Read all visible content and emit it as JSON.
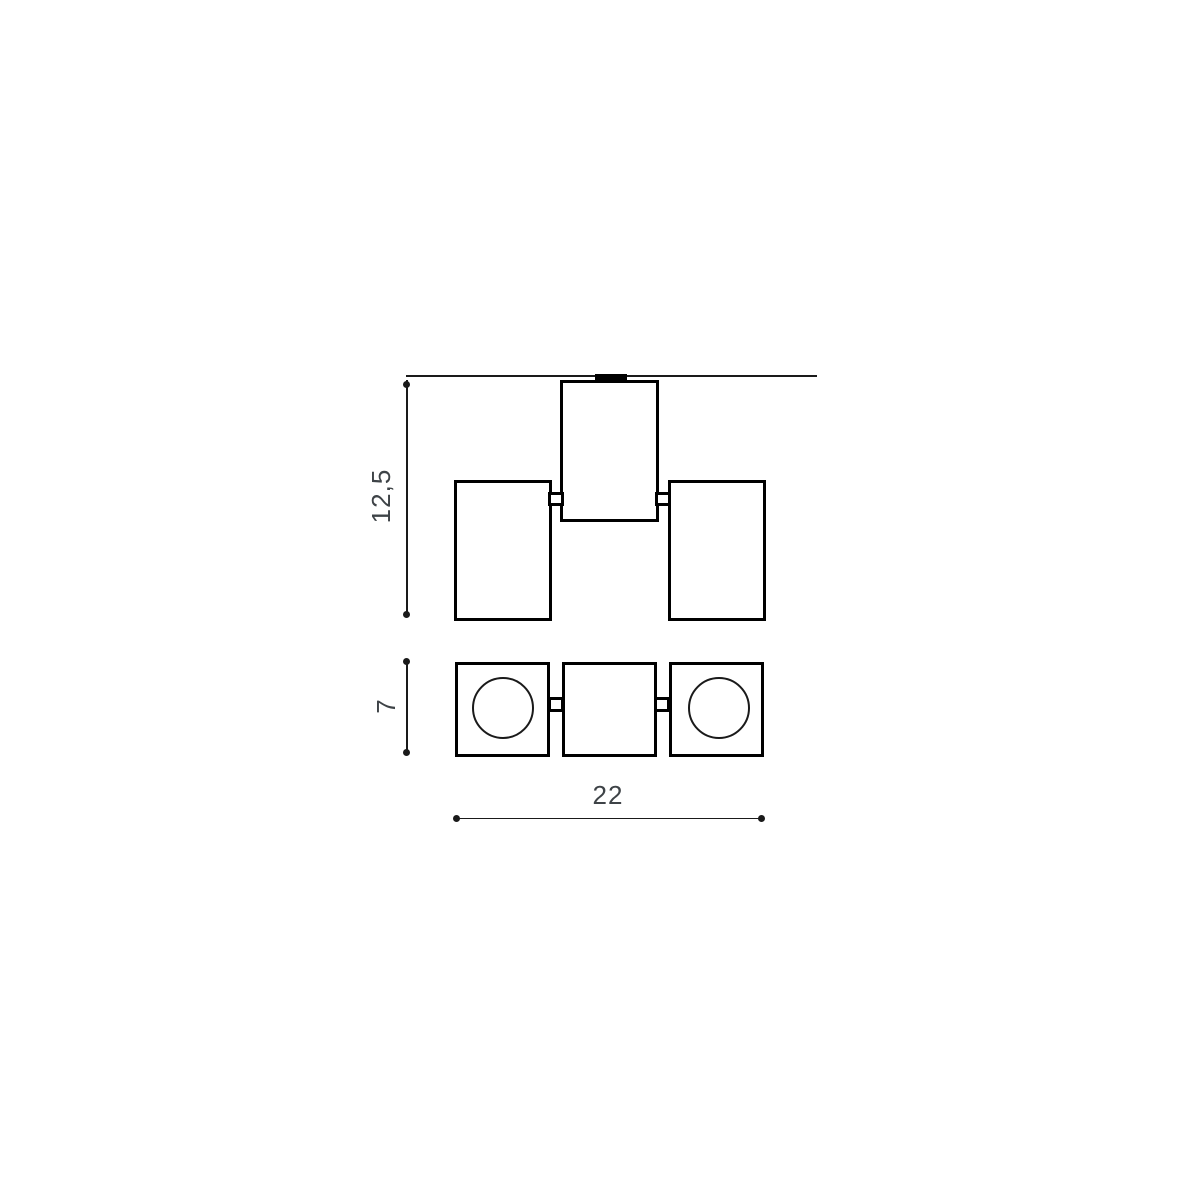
{
  "diagram": {
    "type": "technical-dimension-drawing",
    "dimensions": {
      "height": {
        "label": "12,5",
        "orientation": "vertical"
      },
      "depth": {
        "label": "7",
        "orientation": "vertical"
      },
      "width": {
        "label": "22",
        "orientation": "horizontal"
      }
    }
  },
  "colors": {
    "background": "#ffffff",
    "line": "#000000",
    "dimension_line": "#1a1a1a",
    "label_text": "#3e4347"
  }
}
